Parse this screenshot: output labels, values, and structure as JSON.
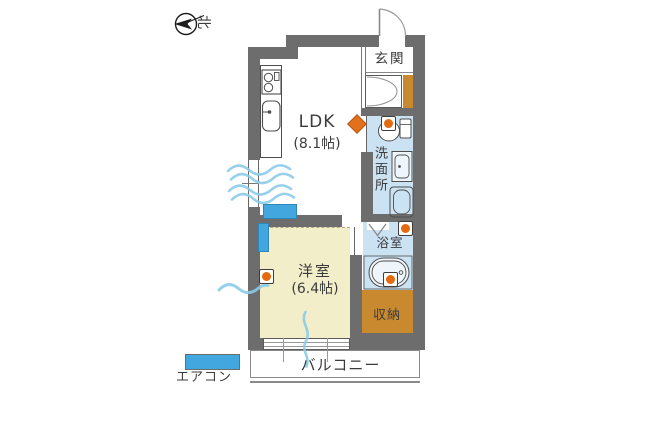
{
  "compass": {
    "north_label": "北"
  },
  "rooms": {
    "genkan": {
      "label": "玄関"
    },
    "ldk": {
      "name": "LDK",
      "size": "(8.1帖)"
    },
    "senmenjo": {
      "label": "洗面所"
    },
    "yokushitsu": {
      "label": "浴室"
    },
    "youshitsu": {
      "name": "洋室",
      "size": "(6.4帖)"
    },
    "shuunou": {
      "label": "収納"
    },
    "balcony": {
      "label": "バルコニー"
    }
  },
  "legend": {
    "aircon_label": "エアコン"
  },
  "colors": {
    "wall": "#6d6d6d",
    "wet_room_floor": "#cbe2f2",
    "bedroom_floor": "#f3eeca",
    "storage": "#c8892f",
    "aircon": "#42a7de",
    "control_button": "#e5690e",
    "door_marker": "#e2711d",
    "wind_line": "#8ccbe9"
  }
}
